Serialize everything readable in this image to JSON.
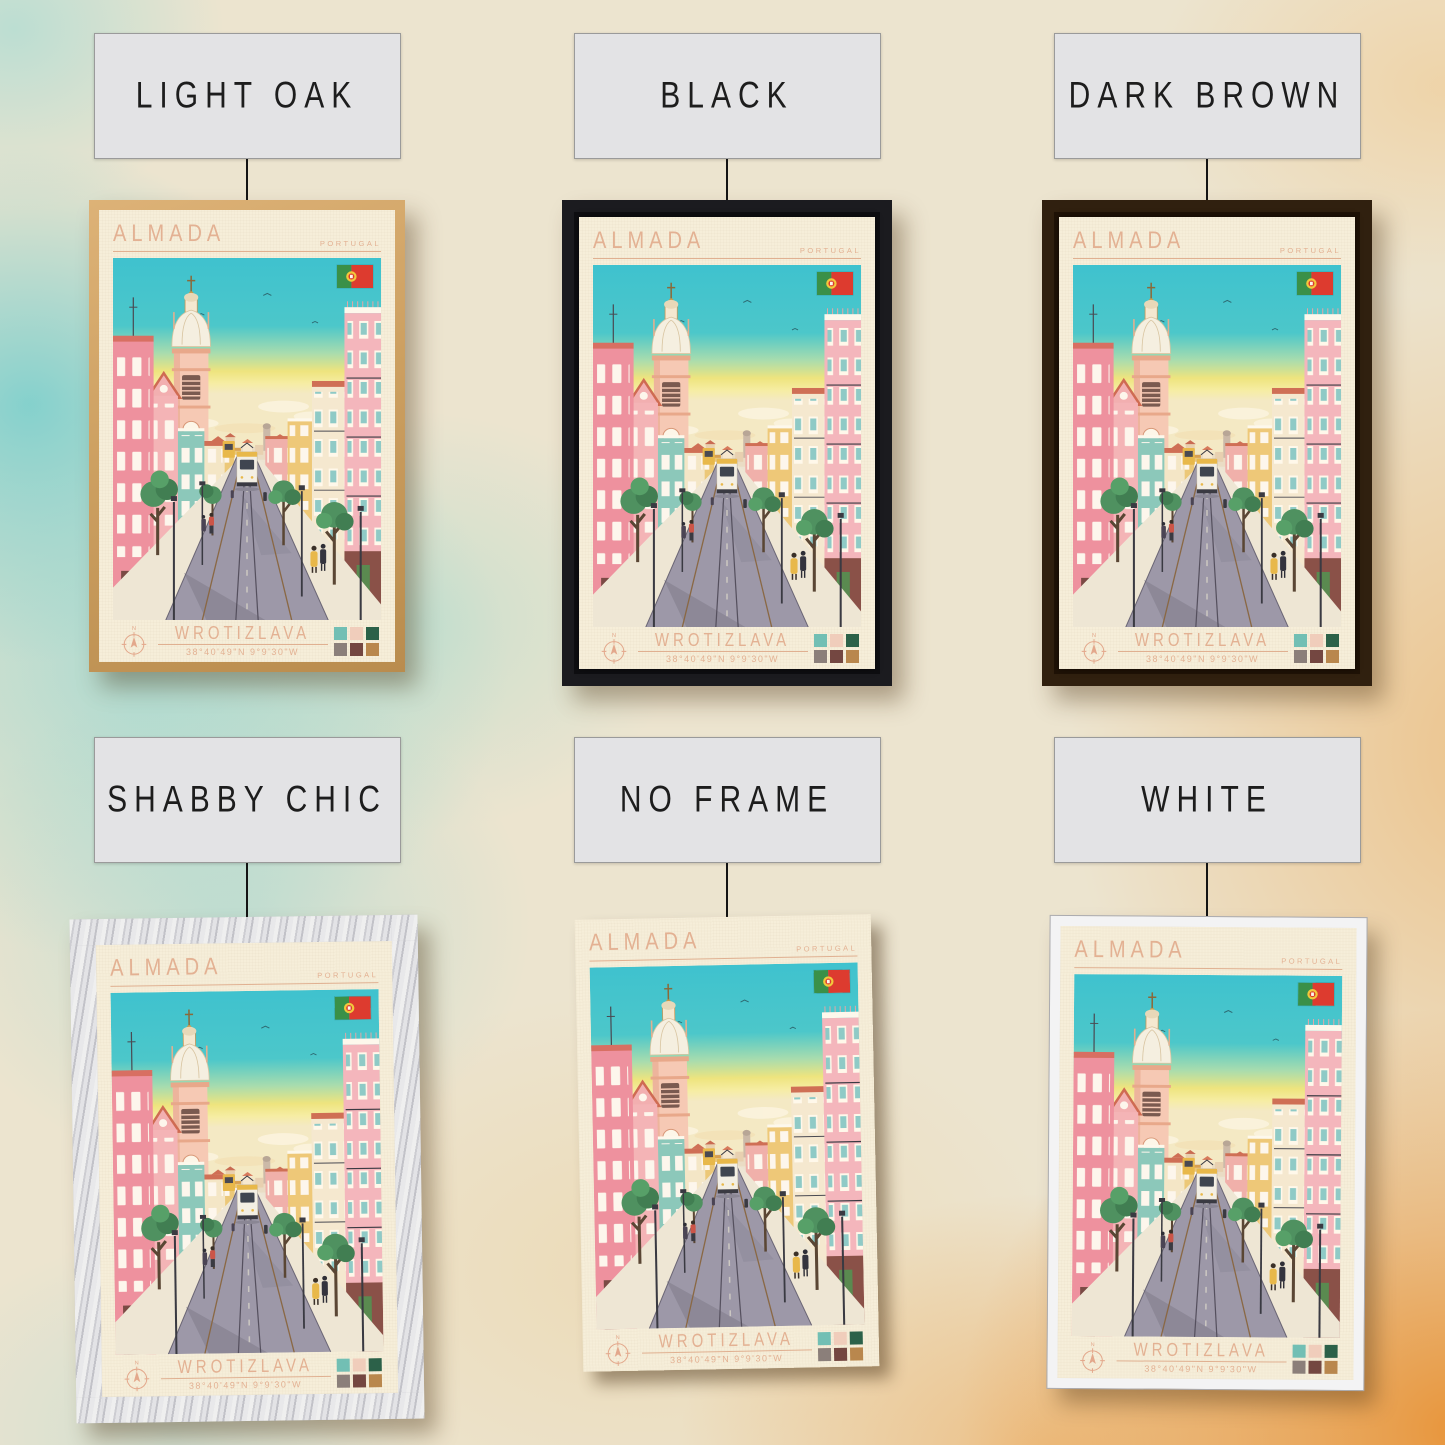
{
  "frames": [
    {
      "id": "light-oak",
      "label": "LIGHT OAK"
    },
    {
      "id": "black",
      "label": "BLACK"
    },
    {
      "id": "dark-brown",
      "label": "DARK BROWN"
    },
    {
      "id": "shabby-chic",
      "label": "SHABBY CHIC"
    },
    {
      "id": "no-frame",
      "label": "NO FRAME"
    },
    {
      "id": "white",
      "label": "WHITE"
    }
  ],
  "poster": {
    "city": "ALMADA",
    "country": "PORTUGAL",
    "subtitle": "WROTIZLAVA",
    "coordinates": "38°40'49\"N 9°9'30\"W",
    "compass_label": "N",
    "flag": "portugal-flag",
    "palette": [
      "#72bfb4",
      "#f0cdbb",
      "#2c6149",
      "#8b7f7a",
      "#744741",
      "#b9874d"
    ],
    "accent_text_color": "#e3b193",
    "paper_color": "#f6eed9"
  }
}
